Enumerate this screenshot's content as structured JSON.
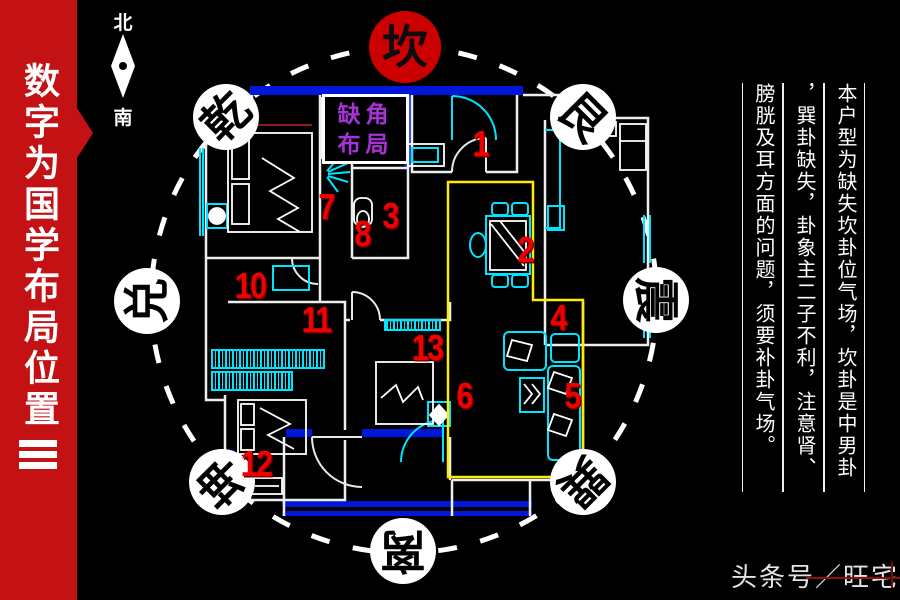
{
  "title_banner": {
    "text": "数字为国学布局位置"
  },
  "compass": {
    "north_label": "北",
    "south_label": "南"
  },
  "corner_label": {
    "line1": "缺角",
    "line2": "布局"
  },
  "bagua": [
    {
      "name": "kan",
      "label": "坎"
    },
    {
      "name": "qian",
      "label": "乾"
    },
    {
      "name": "gen",
      "label": "艮"
    },
    {
      "name": "dui",
      "label": "兑"
    },
    {
      "name": "zhen",
      "label": "震"
    },
    {
      "name": "kun",
      "label": "坤"
    },
    {
      "name": "xun",
      "label": "巽"
    },
    {
      "name": "li",
      "label": "离"
    }
  ],
  "position_numbers": [
    "1",
    "2",
    "3",
    "4",
    "5",
    "6",
    "7",
    "8",
    "10",
    "11",
    "12",
    "13"
  ],
  "analysis_text": {
    "columns": [
      "本户型为缺失坎卦位气场，坎卦是中男卦",
      "，巽卦缺失，卦象主二子不利，注意肾、",
      "膀胱及耳方面的问题，须要补卦气场。"
    ]
  },
  "watermark": {
    "text": "头条号／旺宅旺"
  },
  "colors": {
    "banner_red": "#c31114",
    "kan_circle_red": "#cc0000",
    "wall_blue": "#0016d8",
    "fixture_cyan": "#00e5ff",
    "highlight_yellow": "#ffec00",
    "number_red": "#f00000",
    "label_purple": "#a733d6"
  }
}
